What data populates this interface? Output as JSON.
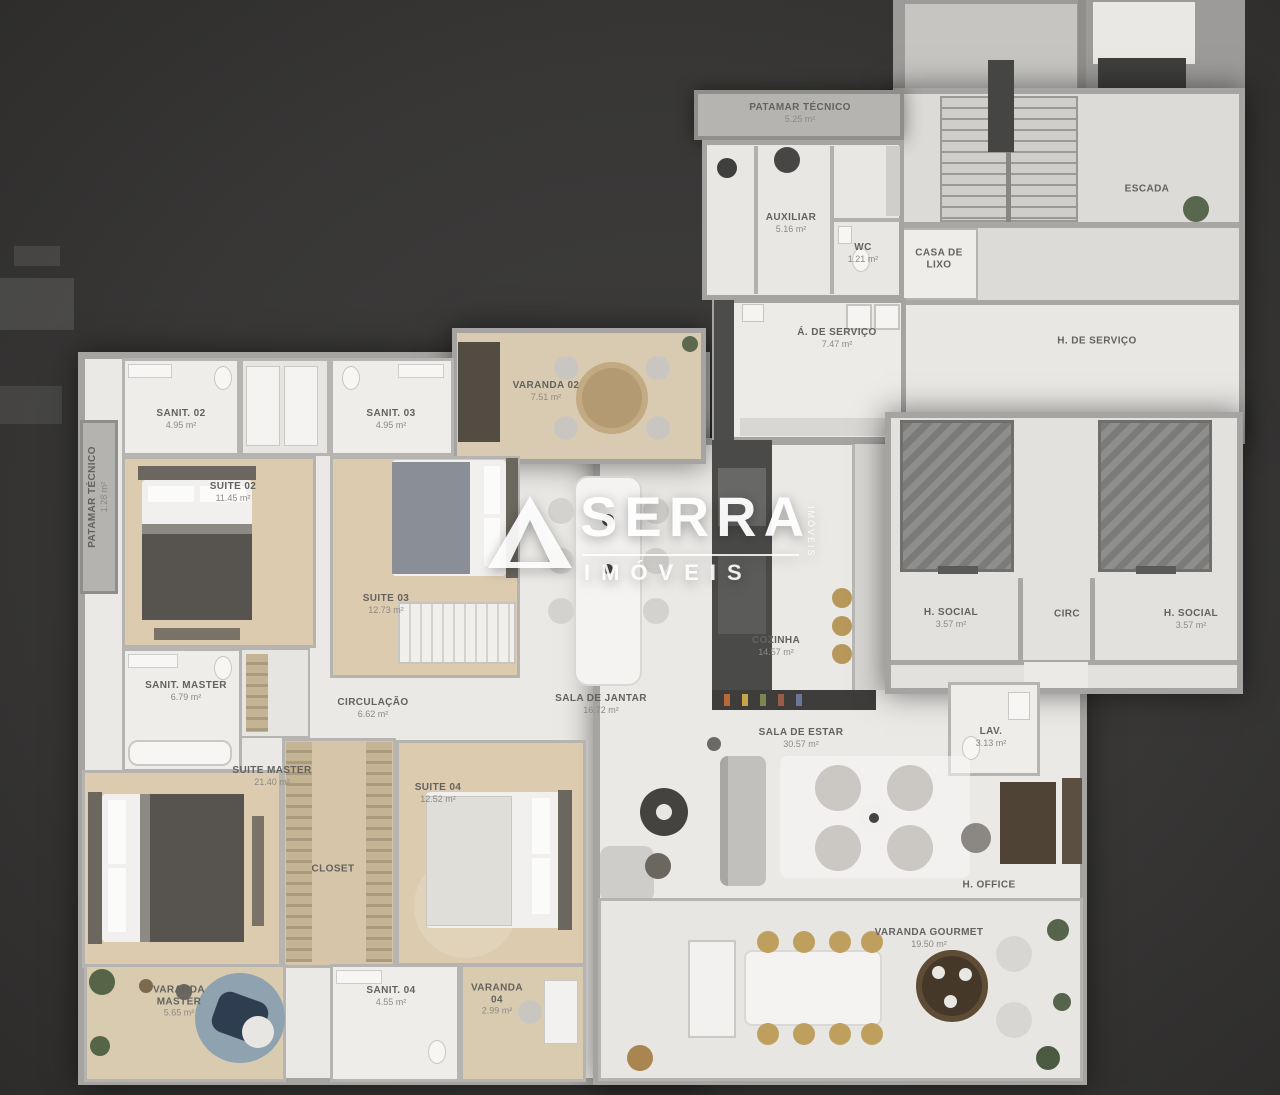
{
  "watermark": {
    "brand": "SERRA",
    "sub": "IMÓVEIS",
    "side": "IMÓVEIS"
  },
  "palette": {
    "background": "#383736",
    "wall": "#a5a4a2",
    "floor_light": "#ebe9e6",
    "floor_wood": "#dccbaf",
    "dark_furniture": "#4a4a48",
    "gold_chairs": "#b8985a",
    "watermark": "#ffffff"
  },
  "rooms": [
    {
      "id": "patamar-tecnico-top",
      "label": "PATAMAR TÉCNICO",
      "area": "5.25 m²",
      "cx": 800,
      "cy": 113
    },
    {
      "id": "auxiliar",
      "label": "AUXILIAR",
      "area": "5.16 m²",
      "cx": 791,
      "cy": 223
    },
    {
      "id": "wc",
      "label": "WC",
      "area": "1.21 m²",
      "cx": 863,
      "cy": 253
    },
    {
      "id": "casa-de-lixo",
      "label": "CASA DE LIXO",
      "area": "",
      "cx": 939,
      "cy": 259,
      "w": 58
    },
    {
      "id": "escada",
      "label": "ESCADA",
      "area": "",
      "cx": 1147,
      "cy": 189
    },
    {
      "id": "area-de-servico",
      "label": "Á. DE SERVIÇO",
      "area": "7.47 m²",
      "cx": 837,
      "cy": 338
    },
    {
      "id": "hall-de-servico",
      "label": "H. DE SERVIÇO",
      "area": "",
      "cx": 1097,
      "cy": 341
    },
    {
      "id": "sanit-02",
      "label": "SANIT. 02",
      "area": "4.95 m²",
      "cx": 181,
      "cy": 419
    },
    {
      "id": "sanit-03",
      "label": "SANIT. 03",
      "area": "4.95 m²",
      "cx": 391,
      "cy": 419
    },
    {
      "id": "varanda-02",
      "label": "VARANDA 02",
      "area": "7.51 m²",
      "cx": 546,
      "cy": 391
    },
    {
      "id": "suite-02",
      "label": "SUITE 02",
      "area": "11.45 m²",
      "cx": 233,
      "cy": 492
    },
    {
      "id": "suite-03",
      "label": "SUITE 03",
      "area": "12.73 m²",
      "cx": 386,
      "cy": 604
    },
    {
      "id": "patamar-tecnico-left",
      "label": "PATAMAR TÉCNICO",
      "area": "1.28 m²",
      "cx": 98,
      "cy": 497,
      "vertical": true
    },
    {
      "id": "h-social-esq",
      "label": "H. SOCIAL",
      "area": "3.57 m²",
      "cx": 951,
      "cy": 618
    },
    {
      "id": "circ",
      "label": "CIRC",
      "area": "",
      "cx": 1067,
      "cy": 614
    },
    {
      "id": "h-social-dir",
      "label": "H. SOCIAL",
      "area": "3.57 m²",
      "cx": 1191,
      "cy": 619
    },
    {
      "id": "sanit-master",
      "label": "SANIT. MASTER",
      "area": "6.79 m²",
      "cx": 186,
      "cy": 691
    },
    {
      "id": "circulacao",
      "label": "CIRCULAÇÃO",
      "area": "6.62 m²",
      "cx": 373,
      "cy": 708
    },
    {
      "id": "sala-de-jantar",
      "label": "SALA DE JANTAR",
      "area": "16.72 m²",
      "cx": 601,
      "cy": 704
    },
    {
      "id": "cozinha",
      "label": "COZINHA",
      "area": "14.57 m²",
      "cx": 776,
      "cy": 646
    },
    {
      "id": "sala-de-estar",
      "label": "SALA DE ESTAR",
      "area": "30.57 m²",
      "cx": 801,
      "cy": 738
    },
    {
      "id": "lav",
      "label": "LAV.",
      "area": "3.13 m²",
      "cx": 991,
      "cy": 737
    },
    {
      "id": "suite-master",
      "label": "SUITE MASTER",
      "area": "21.40 m²",
      "cx": 272,
      "cy": 776
    },
    {
      "id": "suite-04",
      "label": "SUITE 04",
      "area": "12.52 m²",
      "cx": 438,
      "cy": 793
    },
    {
      "id": "closet",
      "label": "CLOSET",
      "area": "",
      "cx": 333,
      "cy": 869
    },
    {
      "id": "h-office",
      "label": "H. OFFICE",
      "area": "",
      "cx": 989,
      "cy": 885
    },
    {
      "id": "varanda-master",
      "label": "VARANDA MASTER",
      "area": "5.65 m²",
      "cx": 179,
      "cy": 1001,
      "w": 92
    },
    {
      "id": "sanit-04",
      "label": "SANIT. 04",
      "area": "4.55 m²",
      "cx": 391,
      "cy": 996
    },
    {
      "id": "varanda-04",
      "label": "VARANDA 04",
      "area": "2.99 m²",
      "cx": 497,
      "cy": 999,
      "w": 64
    },
    {
      "id": "varanda-gourmet",
      "label": "VARANDA GOURMET",
      "area": "19.50 m²",
      "cx": 929,
      "cy": 938
    }
  ]
}
